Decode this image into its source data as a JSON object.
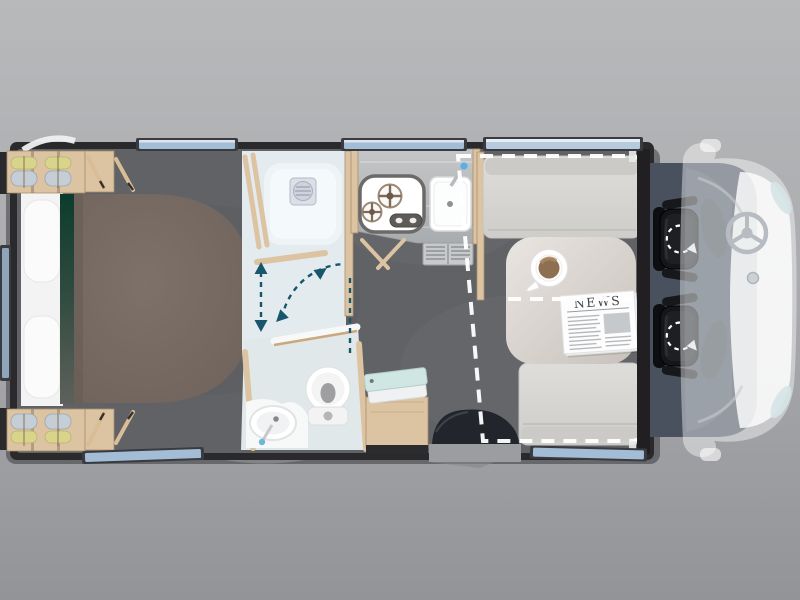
{
  "labels": {
    "newspaper_masthead": "NEWS"
  },
  "colors": {
    "background_top": "#b8b9bb",
    "background_bottom": "#939498",
    "body_shell": "#2a292b",
    "interior_floor": "#606266",
    "bathroom_floor": "#e4ebee",
    "wood": "#dcc3a2",
    "bed_duvet": "#756961",
    "bed_linen": "#f2f3f2",
    "bed_throw_green": "#0c3c2d",
    "cushion": "#d8d7d3",
    "table": "#ddd7d2",
    "window_glass": "#a3bdd6",
    "cab_floor": "#49515f",
    "seat_black": "#151619",
    "ghost_vehicle": "#ffffff",
    "swing_arrow_teal": "#17566b",
    "drop_bed_outline": "#ffffff",
    "towel_mint": "#cfe6e2",
    "coffee": "#8f6f52",
    "clothes_yellow": "#d8d58a",
    "clothes_blue": "#c5ced6"
  },
  "elements": [
    "rear-wardrobe-top",
    "rear-wardrobe-bottom",
    "bed",
    "pillows",
    "green-throw",
    "shower-tray",
    "shower-drain",
    "door-swing-arrows",
    "toilet",
    "vanity-sink",
    "gas-hob",
    "hob-controls",
    "kitchen-sink",
    "kitchen-faucet",
    "vent-grille",
    "entry-step",
    "towel-cabinet",
    "dinette-bench-top",
    "dinette-bench-bottom",
    "dinette-table",
    "coffee-cup",
    "newspaper",
    "drop-down-bed-outline",
    "bulkhead",
    "driver-swivel-seat",
    "passenger-swivel-seat",
    "steering-wheel",
    "ghost-vehicle-front",
    "windows",
    "roof-hatch"
  ]
}
